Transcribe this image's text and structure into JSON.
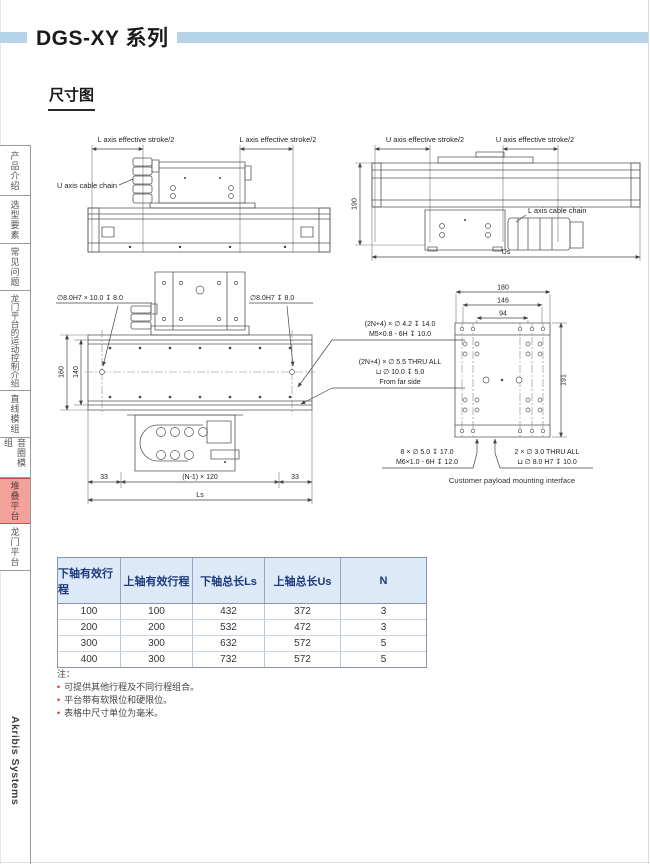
{
  "page": {
    "title": "DGS-XY 系列",
    "section_title": "尺寸图",
    "brand": "Akribis Systems"
  },
  "sidebar": {
    "active": "堆叠平台",
    "tabs": [
      {
        "label": "产品介绍"
      },
      {
        "label": "选型要素"
      },
      {
        "label": "常见问题"
      },
      {
        "label": "龙门平台的运动控制介绍"
      },
      {
        "label": "直线模组"
      },
      {
        "label": "音圈模组"
      },
      {
        "label": "堆叠平台"
      },
      {
        "label": "龙门平台"
      }
    ]
  },
  "drawings": {
    "side_view": {
      "stroke_label": "L axis effective stroke/2",
      "cable_chain": "U axis cable chain"
    },
    "front_view": {
      "stroke_label": "U axis effective stroke/2",
      "cable_chain": "L axis cable chain",
      "dim_height": "190",
      "dim_length": "Us"
    },
    "plan_view": {
      "hole_note_left": "∅8.0H7 × 10.0 ↧ 8.0",
      "hole_note_right": "∅8.0H7 ↧ 8.0",
      "dim_width_outer": "160",
      "dim_width_inner": "140",
      "thread_note_1a": "(2N+4) × ∅ 4.2 ↧ 14.0",
      "thread_note_1b": "M5×0.8 - 6H ↧ 10.0",
      "thread_note_2a": "(2N+4) × ∅ 5.5 THRU ALL",
      "thread_note_2b": "⊔ ∅ 10.0 ↧ 5.0",
      "thread_note_2c": "From far side",
      "dim_end": "33",
      "dim_pitch": "(N-1) × 120",
      "dim_total": "Ls"
    },
    "payload": {
      "dim_180": "180",
      "dim_146": "146",
      "dim_94": "94",
      "dim_191": "191",
      "note_left_a": "8 × ∅ 5.0 ↧ 17.0",
      "note_left_b": "M6×1.0 - 6H ↧ 12.0",
      "note_right_a": "2 × ∅ 3.0 THRU ALL",
      "note_right_b": "⊔ ∅ 8.0 H7 ↧ 10.0",
      "caption": "Customer payload mounting interface"
    }
  },
  "table": {
    "headers": [
      "下轴有效行程",
      "上轴有效行程",
      "下轴总长Ls",
      "上轴总长Us",
      "N"
    ],
    "rows": [
      [
        "100",
        "100",
        "432",
        "372",
        "3"
      ],
      [
        "200",
        "200",
        "532",
        "472",
        "3"
      ],
      [
        "300",
        "300",
        "632",
        "572",
        "5"
      ],
      [
        "400",
        "300",
        "732",
        "572",
        "5"
      ]
    ]
  },
  "notes": {
    "title": "注：",
    "items": [
      "可提供其他行程及不同行程组合。",
      "平台带有软限位和硬限位。",
      "表格中尺寸单位为毫米。"
    ]
  },
  "colors": {
    "accent_bar": "#b7d3e8",
    "active_tab_bg": "#f2a29b",
    "table_header_bg": "#dce9f6",
    "table_border": "#8a90c2",
    "note_bullet": "#c0392b"
  }
}
